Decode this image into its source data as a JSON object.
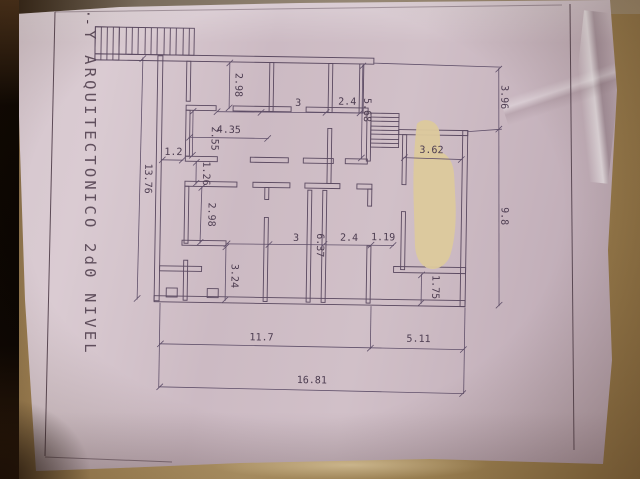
{
  "scene": {
    "description": "Photograph of an architectural floor plan drawing on a pink-white sheet of paper lying on a brown surface",
    "paper_color": "#d1c0c8",
    "ink_color": "#5a4960",
    "patch_color": "#dcc99c",
    "background_color": "#a68a58"
  },
  "title_block": {
    "marks": "·-",
    "title": "Y ARQUITECTONICO 2d0 NIVEL"
  },
  "plan": {
    "dimension_labels": [
      "13.76",
      "2.98",
      "3",
      "2.4",
      "5.68",
      "3.96",
      "4.35",
      "2.55",
      "1.2",
      "3.62",
      "1.26",
      "2.98",
      "9.8",
      "3",
      "6.37",
      "2.4",
      "1.19",
      "3.24",
      "1.75",
      "11.7",
      "5.11",
      "16.81"
    ]
  }
}
